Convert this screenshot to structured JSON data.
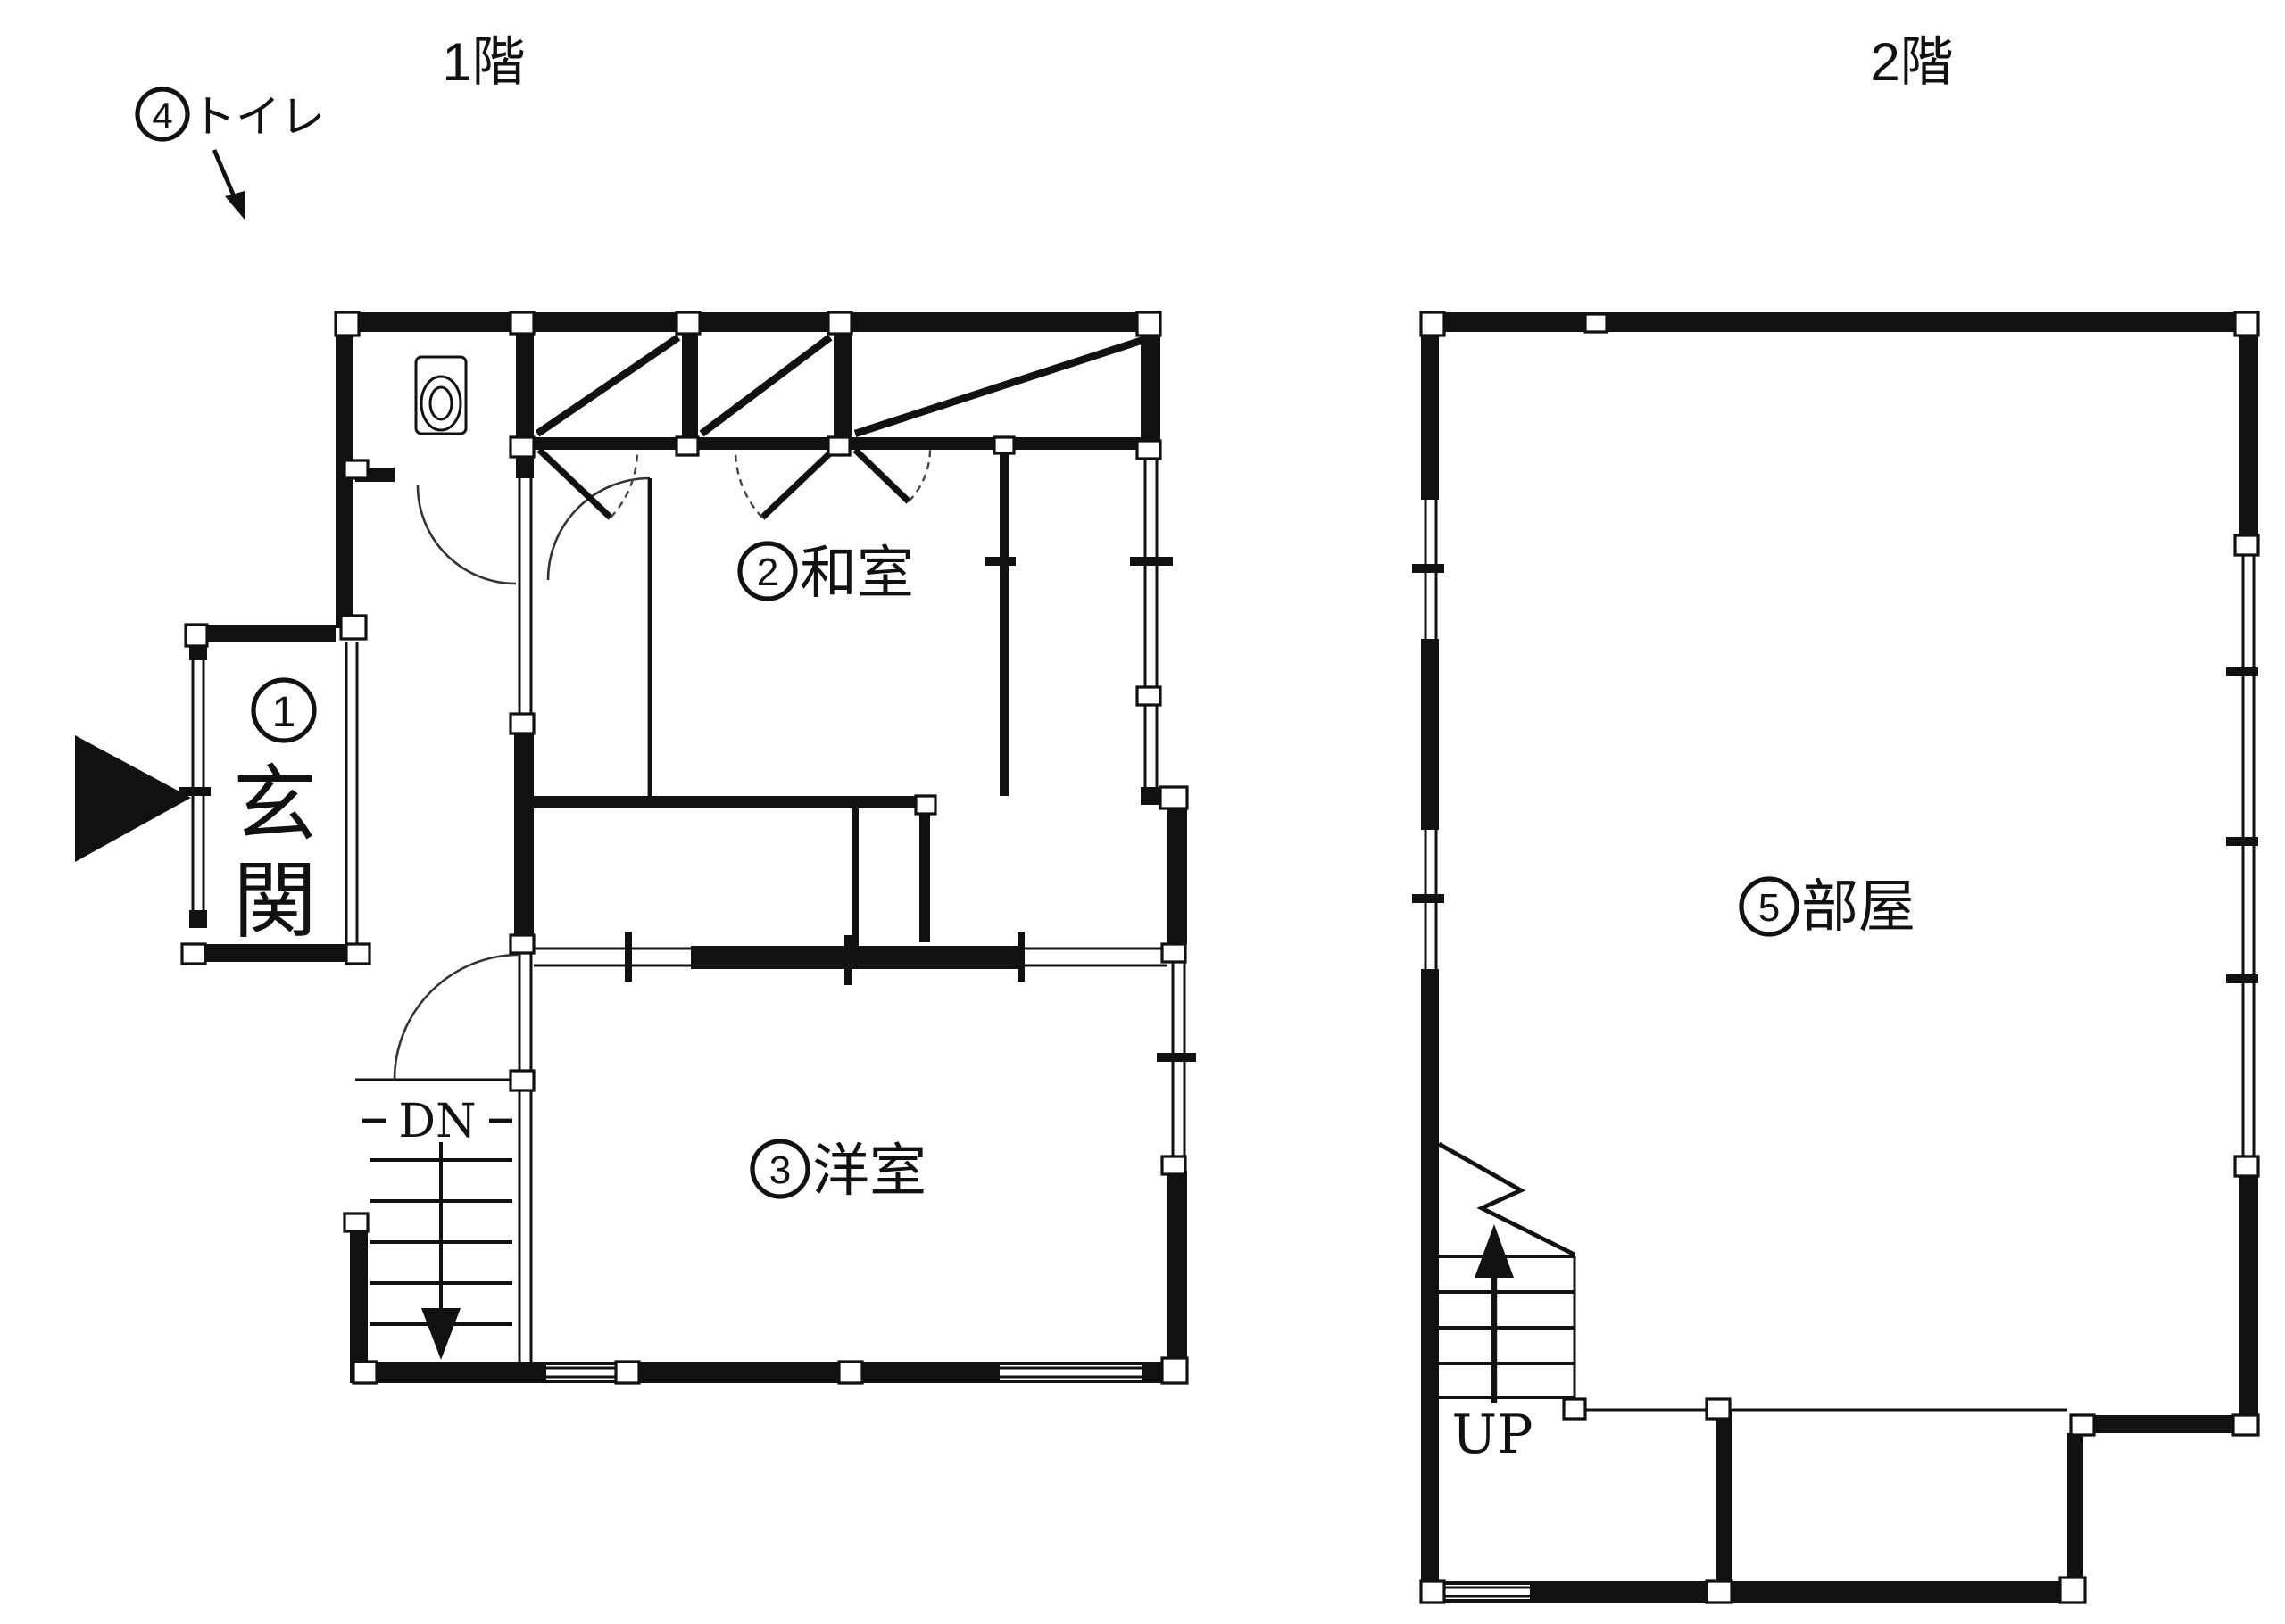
{
  "floor1": {
    "title": "1階",
    "stairs_label": "DN",
    "rooms": [
      {
        "number": "1",
        "name": "玄関",
        "label": "①玄関",
        "name_chars": [
          "玄",
          "関"
        ]
      },
      {
        "number": "2",
        "name": "和室",
        "label": "②和室"
      },
      {
        "number": "3",
        "name": "洋室",
        "label": "③洋室"
      },
      {
        "number": "4",
        "name": "トイレ",
        "label": "④トイレ"
      }
    ]
  },
  "floor2": {
    "title": "2階",
    "stairs_label": "UP",
    "rooms": [
      {
        "number": "5",
        "name": "部屋",
        "label": "⑤部屋"
      }
    ]
  },
  "colors": {
    "ink": "#111111",
    "paper": "#ffffff"
  }
}
